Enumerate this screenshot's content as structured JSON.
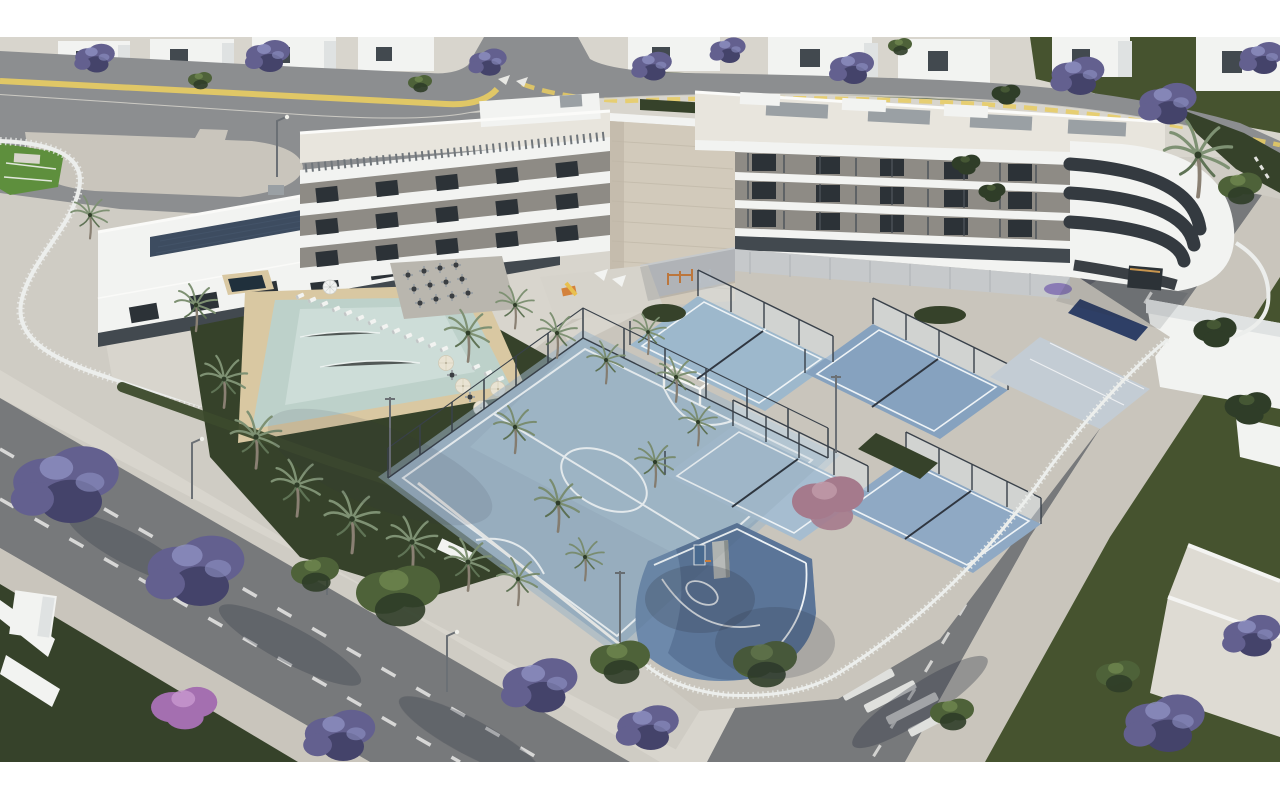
{
  "meta": {
    "title": "Aerial 3D architectural rendering of a residential complex with pool and sports courts",
    "image_width": 1280,
    "image_height": 800,
    "letterbox_top_px": 37,
    "letterbox_bottom_px": 38
  },
  "scene": {
    "regions": [
      "neighbor villas and jacaranda trees along the top",
      "upper road with yellow edge line and side-street junction",
      "entrance plaza and curved white fence garden at top-left",
      "L-shaped white apartment building with stone tower and rounded corner balconies",
      "clubhouse wing with rooftop solar panels",
      "courtyard with lagoon pool, sun loungers, parasols and palm trees",
      "restaurant terrace and playground",
      "futsal court, four padel courts, basketball court",
      "left avenue with dashed lanes, street lamps and jacaranda trees",
      "right street with zebra crosswalk and white flat-roof villas"
    ]
  },
  "palette": {
    "paper": "#ffffff",
    "ground": "#cfccc4",
    "ground2": "#d8d5cd",
    "plaza": "#c9c5bc",
    "asphalt": "#8c8e90",
    "asphalt2": "#77797b",
    "curb": "#dbd8d0",
    "yellow": "#e9cd62",
    "lane": "#e8e8e6",
    "lawn": "#46532f",
    "lawn_bright": "#5e8f3d",
    "lawn_dark": "#36422a",
    "hedge": "#3c4a2c",
    "tree_green": "#4e6239",
    "tree_green2": "#6f874f",
    "tree_dark": "#2f3d28",
    "jaca": "#63608f",
    "jaca_light": "#9093c4",
    "jaca_dark": "#44436a",
    "magenta": "#a46fb0",
    "magenta_light": "#c796ce",
    "pink": "#a57a8c",
    "pink_light": "#c09aa8",
    "white_build": "#f2f3f1",
    "white_shade": "#dfe2e2",
    "stone": "#d2cabb",
    "stone_line": "#c0b8a8",
    "roof_pale": "#e8e5dd",
    "glazing": "#2c3237",
    "glazing2": "#42494f",
    "recess": "#8e8b85",
    "slat": "#c6c9cb",
    "solar": "#3d4c60",
    "hvac": "#9aa0a4",
    "futsal": "#9db4c6",
    "futsal_light": "#aec3d3",
    "padel1": "#9db8cc",
    "padel2": "#86a2bf",
    "padel3": "#a6bdd0",
    "padel4": "#8fa9c4",
    "basket": "#6d89ab",
    "basket_shade": "#4d6489",
    "minicourt": "#c3ccd4",
    "courtline": "#eef3f6",
    "sand": "#d9c8a2",
    "water": "#bdd1ca",
    "water_light": "#d6e4de",
    "spa": "#20303c",
    "fence_white": "#eceeec",
    "fence_dark": "#3a424b",
    "palm_trunk": "#8a8073",
    "palm_frond": "#7e9173",
    "palm_frond_dark": "#5f7355",
    "lamp": "#6b7075",
    "shadow": "#2e3340",
    "cream": "#e9e3d3",
    "orange": "#d4823c",
    "navy": "#2e3f66",
    "table": "#3a3e42"
  }
}
